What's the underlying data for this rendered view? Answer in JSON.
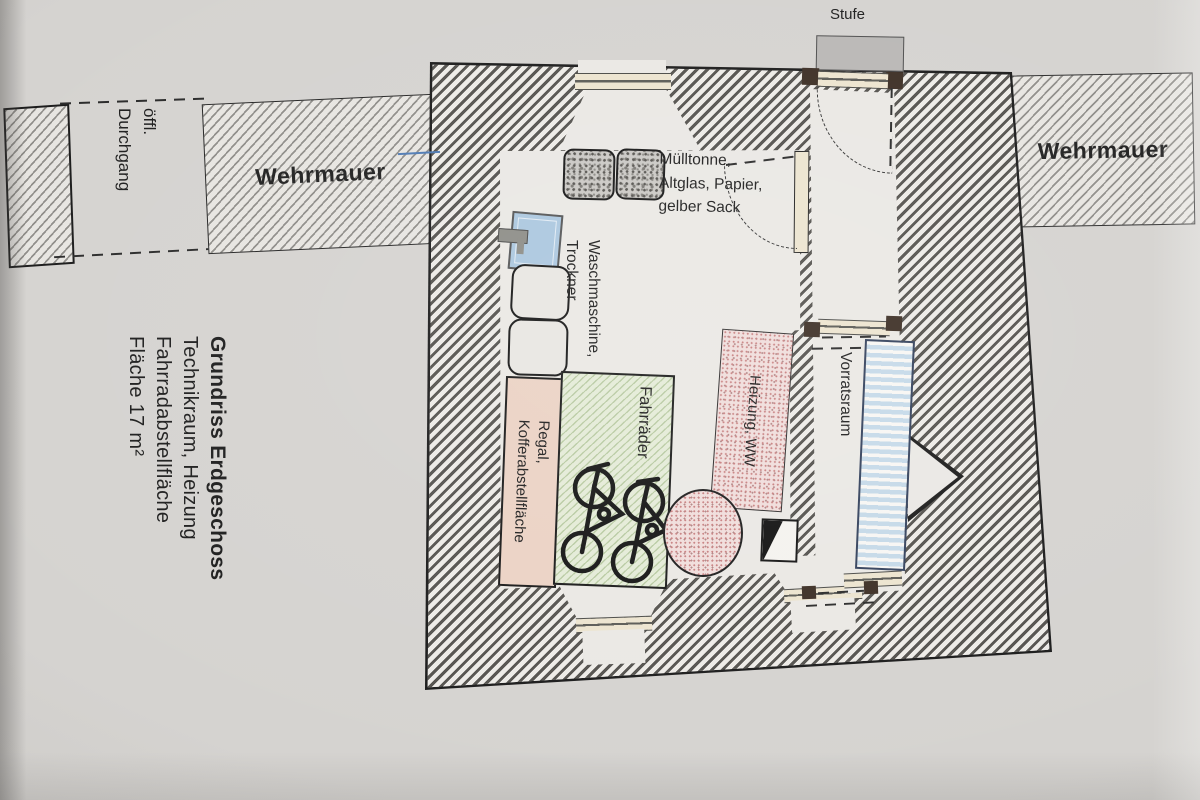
{
  "title_block": {
    "line1": "Grundriss Erdgeschoss",
    "line2": "Technikraum, Heizung",
    "line3": "Fahrradabstellfläche",
    "line4": "Fläche 17 m²"
  },
  "labels": {
    "stufe": "Stufe",
    "wehrmauer_left": "Wehrmauer",
    "wehrmauer_right": "Wehrmauer",
    "passage_line1": "öffl.",
    "passage_line2": "Durchgang",
    "muell_line1": "Mülltonne,",
    "muell_line2": "Altglas, Papier,",
    "muell_line3": "gelber Sack",
    "wasch_line1": "Waschmaschine,",
    "wasch_line2": "Trockner",
    "fahrraeder": "Fahrräder",
    "regal_line1": "Regal,",
    "regal_line2": "Kofferabstellfläche",
    "heizung": "Heizung, WW",
    "vorratsraum": "Vorratsraum"
  },
  "colors": {
    "wall_hatch_dark": "#54524e",
    "wall_hatch_light": "#edebe7",
    "mauer_hatch": "#8f8d89",
    "outline": "#1a1a1a",
    "room_fill": "#eae8e4",
    "green_area": "#e4ebd7",
    "pink_area": "#ebd2c4",
    "heizung_pink": "#f0dddb",
    "heizung_dot": "#c77f7f",
    "sink_blue": "#abc7df",
    "shelf_blue": "#c5d9e8",
    "shelf_border": "#33415c",
    "cream": "#ece4cf",
    "door_jamb_brown": "#3c2e24",
    "step_gray": "#b9b7b5",
    "marker_blue": "#4d79b3"
  }
}
